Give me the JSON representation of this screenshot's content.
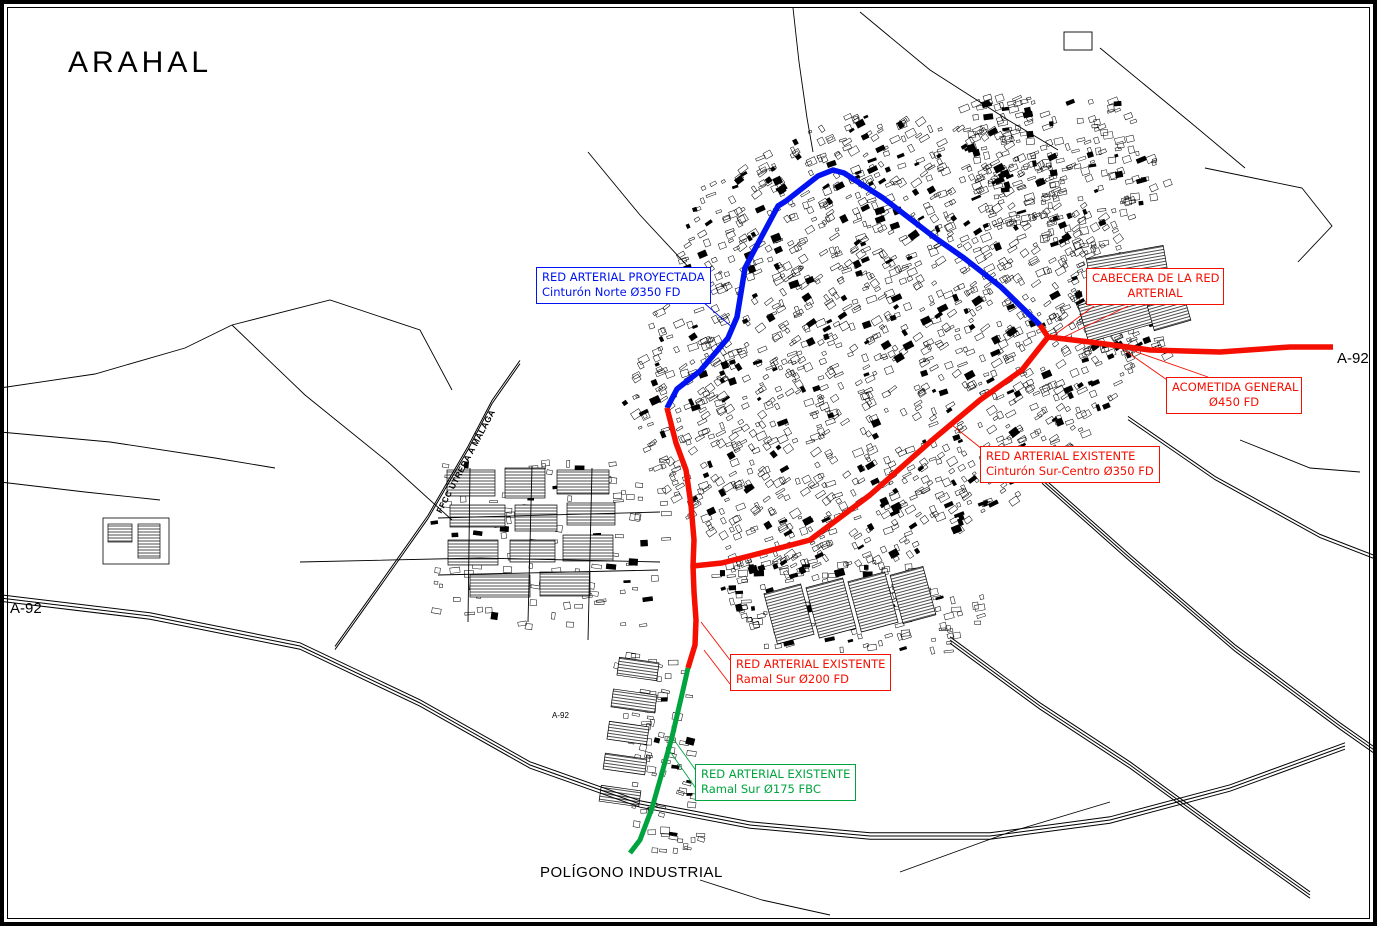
{
  "title": "ARAHAL",
  "colors": {
    "projected_blue": "#0013f0",
    "existing_red": "#f50f00",
    "existing_green": "#00a43f",
    "ink": "#000000"
  },
  "labels": {
    "proyectada": {
      "line1": "RED ARTERIAL PROYECTADA",
      "line2": "Cinturón Norte Ø350 FD"
    },
    "cabecera": {
      "line1": "CABECERA DE LA RED",
      "line2": "ARTERIAL"
    },
    "acometida": {
      "line1": "ACOMETIDA GENERAL",
      "line2": "Ø450 FD"
    },
    "sur_centro": {
      "line1": "RED ARTERIAL EXISTENTE",
      "line2": "Cinturón Sur-Centro Ø350 FD"
    },
    "ramal_200": {
      "line1": "RED ARTERIAL EXISTENTE",
      "line2": "Ramal Sur Ø200 FD"
    },
    "ramal_175": {
      "line1": "RED ARTERIAL EXISTENTE",
      "line2": "Ramal Sur Ø175 FBC"
    }
  },
  "annotations": {
    "poligono": "POLÍGONO INDUSTRIAL",
    "a92_left": "A-92",
    "a92_right": "A-92",
    "a92_small": "A-92",
    "railway": "FFCC UTRERA A MÁLAGA"
  }
}
